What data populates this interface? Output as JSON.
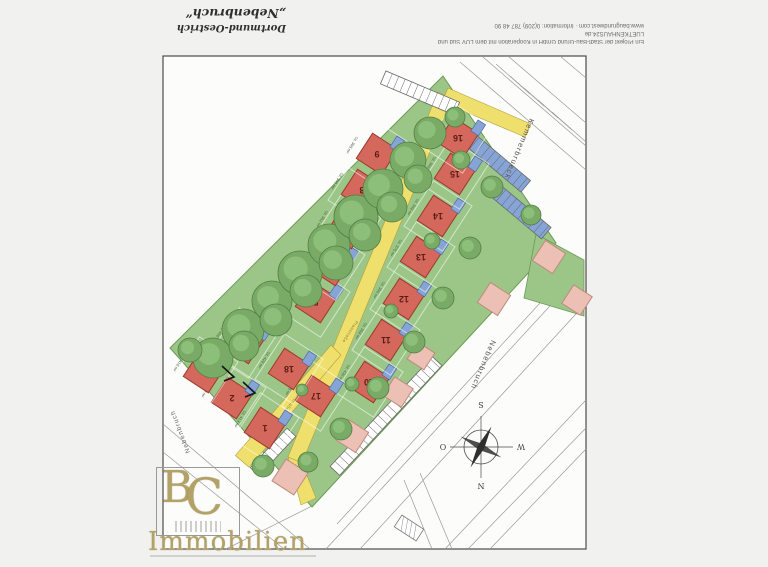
{
  "header": {
    "location": "Dortmund-Oestrich",
    "project": "„Nebenbruch“",
    "info_line1": "Ein Projekt der Stadt-Bau-Grund GmbH in Kooperation mit dem LUV Süd und LUETKENHAUS24.de",
    "info_line2": "www.baugrundwest.com · Information: 0(209) 787 48 90"
  },
  "logo": {
    "letter_b": "B",
    "letter_c": "C",
    "caption": "Immobilien"
  },
  "compass": {
    "north": "N",
    "south": "S",
    "east": "O",
    "west": "W"
  },
  "streets": {
    "ne_street": "Kemmerbrueck",
    "se_street": "Nebenbruch",
    "sw_street": "Nebenbruch",
    "road_label": "Planstraße"
  },
  "colors": {
    "lawn_green": "#9cc687",
    "road_yellow": "#efdf6d",
    "lot_red": "#d4685c",
    "lot_red_border": "#9c3b2f",
    "existing_pink": "#ecc0b4",
    "existing_pink_border": "#bd8b7c",
    "garage_blue": "#86a5d6",
    "garage_blue_border": "#4c6ca8",
    "tree_green": "#79ab67",
    "tree_dark": "#527f43",
    "tree_light": "#97c983",
    "logo_gold": "#b2a267"
  },
  "site": {
    "lots": [
      {
        "n": "1",
        "a": "ca. 413 m²",
        "x": 265,
        "y": 428
      },
      {
        "n": "2",
        "a": "ca. 379 m²",
        "x": 232,
        "y": 398
      },
      {
        "n": "3",
        "a": "ca. 410 m²",
        "x": 204,
        "y": 372
      },
      {
        "n": "4",
        "a": "ca. 450 m²",
        "x": 244,
        "y": 343
      },
      {
        "n": "5",
        "a": "ca. 356 m²",
        "x": 316,
        "y": 302
      },
      {
        "n": "6",
        "a": "ca. 338 m²",
        "x": 331,
        "y": 265
      },
      {
        "n": "7",
        "a": "ca. 352 m²",
        "x": 347,
        "y": 228
      },
      {
        "n": "8",
        "a": "ca. 341 m²",
        "x": 362,
        "y": 190
      },
      {
        "n": "9",
        "a": "ca. 365 m²",
        "x": 377,
        "y": 154
      },
      {
        "n": "10",
        "a": "ca. 430 m²",
        "x": 369,
        "y": 382
      },
      {
        "n": "11",
        "a": "ca. 358 m²",
        "x": 386,
        "y": 340
      },
      {
        "n": "12",
        "a": "ca. 350 m²",
        "x": 404,
        "y": 299
      },
      {
        "n": "13",
        "a": "ca. 375 m²",
        "x": 421,
        "y": 257
      },
      {
        "n": "14",
        "a": "ca. 348 m²",
        "x": 438,
        "y": 216
      },
      {
        "n": "15",
        "a": "ca. 360 m²",
        "x": 455,
        "y": 174
      },
      {
        "n": "16",
        "a": "ca. 372 m²",
        "x": 458,
        "y": 138
      },
      {
        "n": "17",
        "a": "ca. 395 m²",
        "x": 316,
        "y": 396
      },
      {
        "n": "18",
        "a": "ca. 420 m²",
        "x": 289,
        "y": 369
      }
    ],
    "existing_buildings": [
      [
        290,
        477,
        13
      ],
      [
        352,
        436,
        12
      ],
      [
        398,
        392,
        11
      ],
      [
        421,
        356,
        10
      ],
      [
        494,
        299,
        12
      ],
      [
        549,
        257,
        12
      ],
      [
        577,
        300,
        11
      ]
    ],
    "trees": [
      [
        213,
        358,
        20
      ],
      [
        243,
        330,
        21
      ],
      [
        272,
        301,
        20
      ],
      [
        300,
        273,
        22
      ],
      [
        329,
        245,
        21
      ],
      [
        356,
        217,
        22
      ],
      [
        383,
        189,
        20
      ],
      [
        408,
        160,
        18
      ],
      [
        430,
        133,
        16
      ],
      [
        244,
        346,
        15
      ],
      [
        276,
        320,
        16
      ],
      [
        306,
        291,
        16
      ],
      [
        336,
        263,
        17
      ],
      [
        365,
        235,
        16
      ],
      [
        392,
        207,
        15
      ],
      [
        418,
        179,
        14
      ],
      [
        190,
        350,
        12
      ],
      [
        455,
        117,
        10
      ],
      [
        492,
        187,
        11
      ],
      [
        470,
        248,
        11
      ],
      [
        443,
        298,
        11
      ],
      [
        414,
        342,
        11
      ],
      [
        378,
        388,
        11
      ],
      [
        341,
        429,
        11
      ],
      [
        308,
        462,
        10
      ],
      [
        263,
        466,
        11
      ],
      [
        531,
        215,
        10
      ],
      [
        352,
        384,
        7
      ],
      [
        391,
        311,
        7
      ],
      [
        302,
        390,
        6
      ],
      [
        432,
        241,
        8
      ],
      [
        461,
        160,
        9
      ]
    ],
    "parking": [
      {
        "x": 420,
        "y": 93,
        "len": 80,
        "h": 14,
        "rot": 23,
        "blue": false
      },
      {
        "x": 492,
        "y": 158,
        "len": 88,
        "h": 15,
        "rot": 40,
        "blue": true
      },
      {
        "x": 521,
        "y": 212,
        "len": 66,
        "h": 15,
        "rot": 40,
        "blue": true
      },
      {
        "x": 386,
        "y": 416,
        "len": 150,
        "h": 13,
        "rot": -47,
        "blue": false
      },
      {
        "x": 273,
        "y": 452,
        "len": 54,
        "h": 12,
        "rot": -47,
        "blue": false
      }
    ],
    "parcel_lines": [
      [
        460,
        62,
        586,
        170
      ],
      [
        483,
        57,
        586,
        146
      ],
      [
        508,
        56,
        586,
        123
      ],
      [
        496,
        64,
        530,
        94
      ],
      [
        510,
        76,
        544,
        106
      ],
      [
        524,
        88,
        558,
        118
      ],
      [
        538,
        100,
        572,
        130
      ],
      [
        552,
        112,
        586,
        142
      ],
      [
        560,
        56,
        586,
        78
      ],
      [
        326,
        549,
        572,
        282
      ],
      [
        360,
        549,
        586,
        303
      ],
      [
        337,
        524,
        574,
        266
      ],
      [
        468,
        549,
        586,
        428
      ],
      [
        490,
        549,
        586,
        449
      ],
      [
        445,
        549,
        586,
        400
      ],
      [
        404,
        480,
        432,
        549
      ],
      [
        420,
        473,
        452,
        549
      ],
      [
        163,
        424,
        310,
        549
      ],
      [
        163,
        452,
        284,
        549
      ],
      [
        226,
        549,
        312,
        506
      ],
      [
        150,
        556,
        316,
        556
      ]
    ]
  }
}
